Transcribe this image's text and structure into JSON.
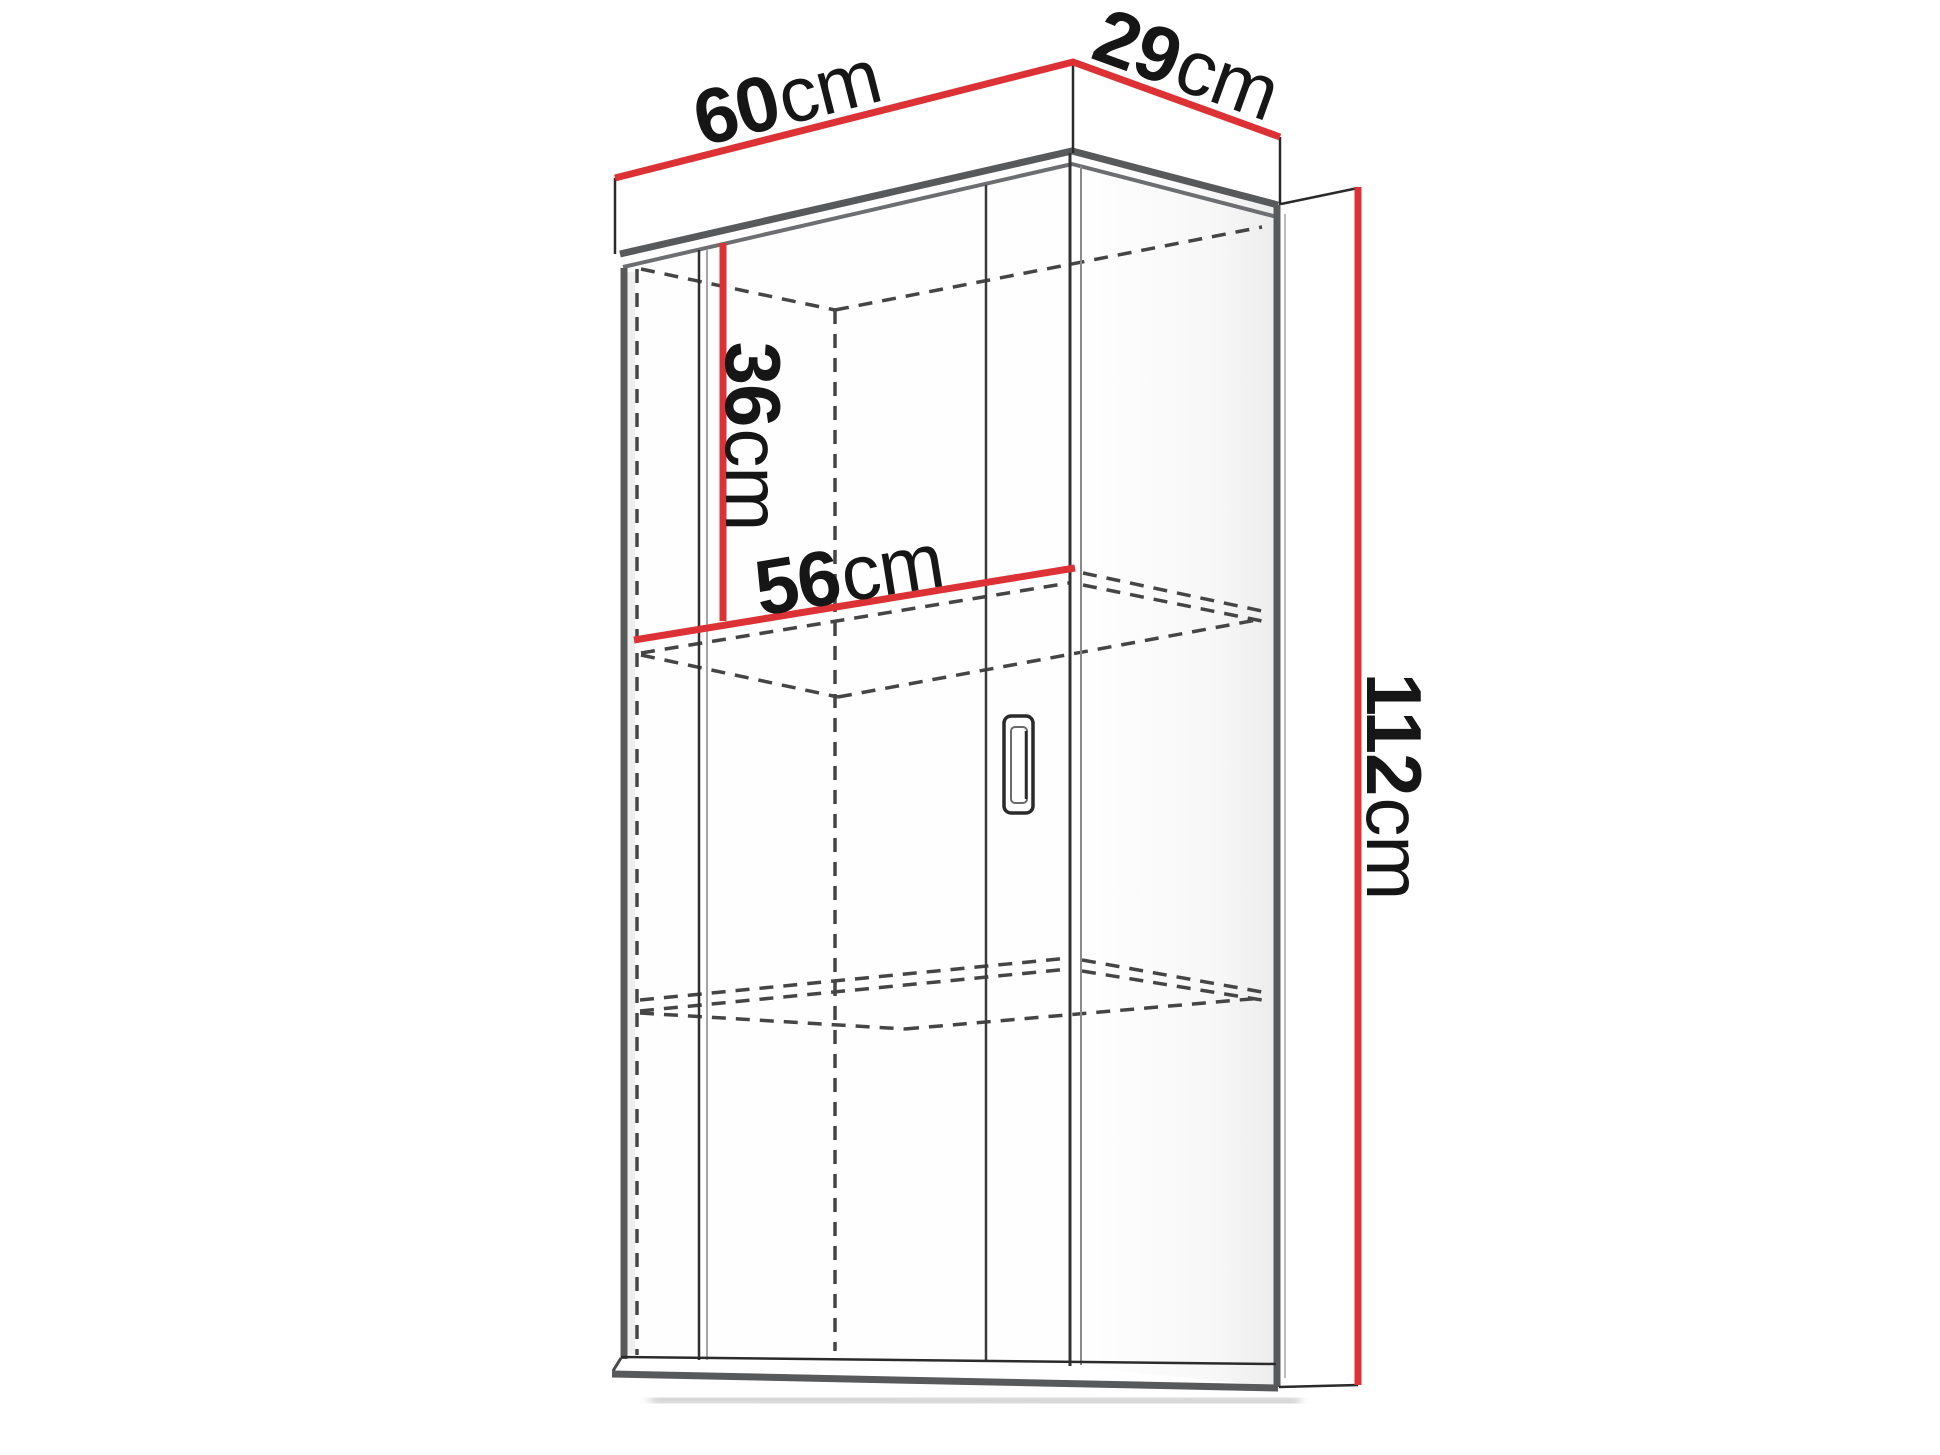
{
  "diagram": {
    "subject": "wall-cabinet-dimension-drawing",
    "dimensions": {
      "width": {
        "value": "60",
        "unit": "cm"
      },
      "depth": {
        "value": "29",
        "unit": "cm"
      },
      "height": {
        "value": "112",
        "unit": "cm"
      },
      "upper_section_height": {
        "value": "36",
        "unit": "cm"
      },
      "interior_width": {
        "value": "56",
        "unit": "cm"
      }
    },
    "colors": {
      "dimension_line": "#dc3236",
      "outline_strong": "#58595b",
      "outline_mid": "#6d6e71",
      "outline_thin": "#2a2a2a",
      "hidden_edge": "#454545",
      "label_text": "#161616",
      "background": "#ffffff"
    }
  }
}
